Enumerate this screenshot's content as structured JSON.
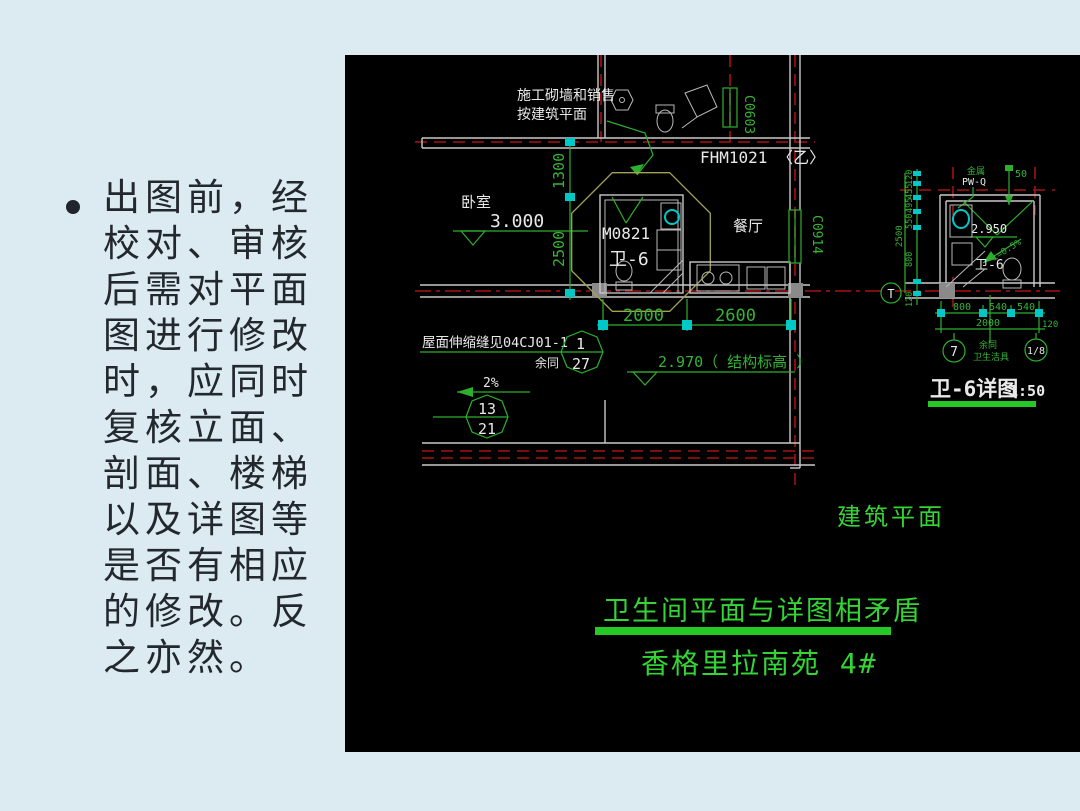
{
  "slide": {
    "bullet_glyph": "•",
    "lines": [
      "出图前，经",
      "校对、审核",
      "后需对平面",
      "图进行修改",
      "时，应同时",
      "复核立面、",
      "剖面、楼梯",
      "以及详图等",
      "是否有相应",
      "的修改。反",
      "之亦然。"
    ]
  },
  "colors": {
    "slide_background": "#dbebf1",
    "cad_background": "#000000",
    "cad_green": "#2eaf2e",
    "caption_green": "#35d435",
    "wall_white": "#c9c9c9",
    "axis_red": "#a51212",
    "tick_cyan": "#00c8c8",
    "cloud_olive": "#a3a351"
  },
  "plan": {
    "note_line1": "施工砌墙和销售",
    "note_line2": "按建筑平面",
    "room_bedroom": "卧室",
    "level_bedroom": "3.000",
    "door_top": "FHM1021 〈乙〉",
    "window_top": "C0603",
    "door_bath": "M0821",
    "bath_name": "卫-6",
    "room_dining": "餐厅",
    "window_right": "C0914",
    "dim_v_1300": "1300",
    "dim_v_2500": "2500",
    "dim_h_2000": "2000",
    "dim_h_2600": "2600",
    "roof_note": "屋面伸缩缝见04CJ01-1",
    "roof_note_rest": "余同",
    "ref1_num": "1",
    "ref1_den": "27",
    "slope": "2%",
    "ref2_num": "13",
    "ref2_den": "21",
    "level_struct": "2.970（ 结构标高 ）",
    "caption": "建筑平面"
  },
  "detail": {
    "dims_left": [
      "120",
      "455",
      "495",
      "550",
      "800"
    ],
    "dim_left_total": "2500",
    "dim_left_bottom": "120",
    "note_top1": "金属",
    "note_top2": "PW-Q",
    "pipe": "50",
    "level": "2.950",
    "slope": "i=0.5%",
    "bath_name": "卫-6",
    "dims_bottom": [
      "800",
      "540",
      "540"
    ],
    "dim_bottom_total": "2000",
    "dim_bottom_right": "120",
    "grid_t": "T",
    "grid_7": "7",
    "grid_8": "1/8",
    "note_small1": "余同",
    "note_small2": "卫生洁具",
    "title": "卫-6详图",
    "scale": "1:50"
  },
  "captions": {
    "conflict": "卫生间平面与详图相矛盾",
    "project": "香格里拉南苑 4#"
  }
}
